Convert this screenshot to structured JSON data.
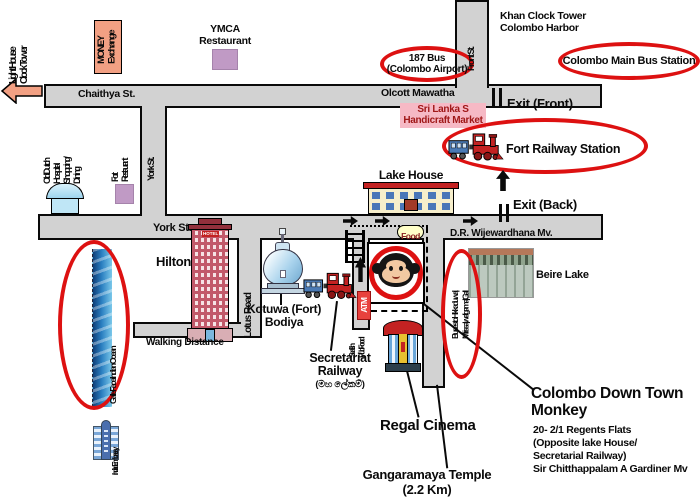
{
  "colors": {
    "road_gray": "#d2d2d2",
    "highlight_red": "#dd1111",
    "salmon": "#f2a083",
    "plum": "#c09ac5",
    "pink": "#f6b9c5",
    "food_yellow": "#ffffc8",
    "atm_red": "#e8413d"
  },
  "roads": {
    "chaithya": "Chaithya St.",
    "olcott": "Olcott Mawatha",
    "front": "Front St.",
    "york_vertical": "York St.",
    "york_horizontal": "York St.",
    "dr_wijewardhana": "D.R. Wijewardhana Mv.",
    "lotus": "Lotus Road",
    "walking_distance": "Walking Distance"
  },
  "landmarks": {
    "light_house": "Light House\nClock Tower",
    "money_exchange": "MONEY\nExchange",
    "ymca": "YMCA\nRestaurant",
    "khan_clock_tower": "Khan Clock Tower\nColombo Harbor",
    "old_dutch": "Old Dutch\nHospital\nShopping/\nDining",
    "fort_restaurant": "Fort\nRestaurant",
    "handicraft_market": "Sri Lanka S\nHandicraft Market",
    "lake_house": "Lake House",
    "hilton": "Hilton",
    "hilton_sign": "HOTEL",
    "kotuwa_bodiya": "Kotuwa (Fort)\nBodiya",
    "beire_lake": "Beire Lake",
    "galle_face": "Galle Face/Indian Ocean",
    "indian_embassy": "Indian Embassy",
    "secretariat_railway": "Secretariat\nRailway",
    "secretariat_railway_si": "(මහ ලේකම්)",
    "seafish": "Seafish\nPub/Food",
    "regal_cinema": "Regal Cinema",
    "gangaramaya": "Gangaramaya Temple\n(2.2 Km)",
    "atm": "ATM",
    "food": "Food"
  },
  "transit": {
    "bus_187": "187 Bus\n(Colombo Airport)",
    "main_bus_station": "Colombo Main Bus Station",
    "fort_railway_station": "Fort Railway Station",
    "exit_front": "Exit (Front)",
    "exit_back": "Exit (Back)",
    "buses_south": "Buses to Hikkaduwa|\nMirissa| weligama| Gall"
  },
  "destination": {
    "name": "Colombo Down Town\nMonkey",
    "address": "20- 2/1 Regents Flats\n(Opposite lake House/\nSecretarial Railway)\nSir Chitthappalam A Gardiner Mv"
  }
}
